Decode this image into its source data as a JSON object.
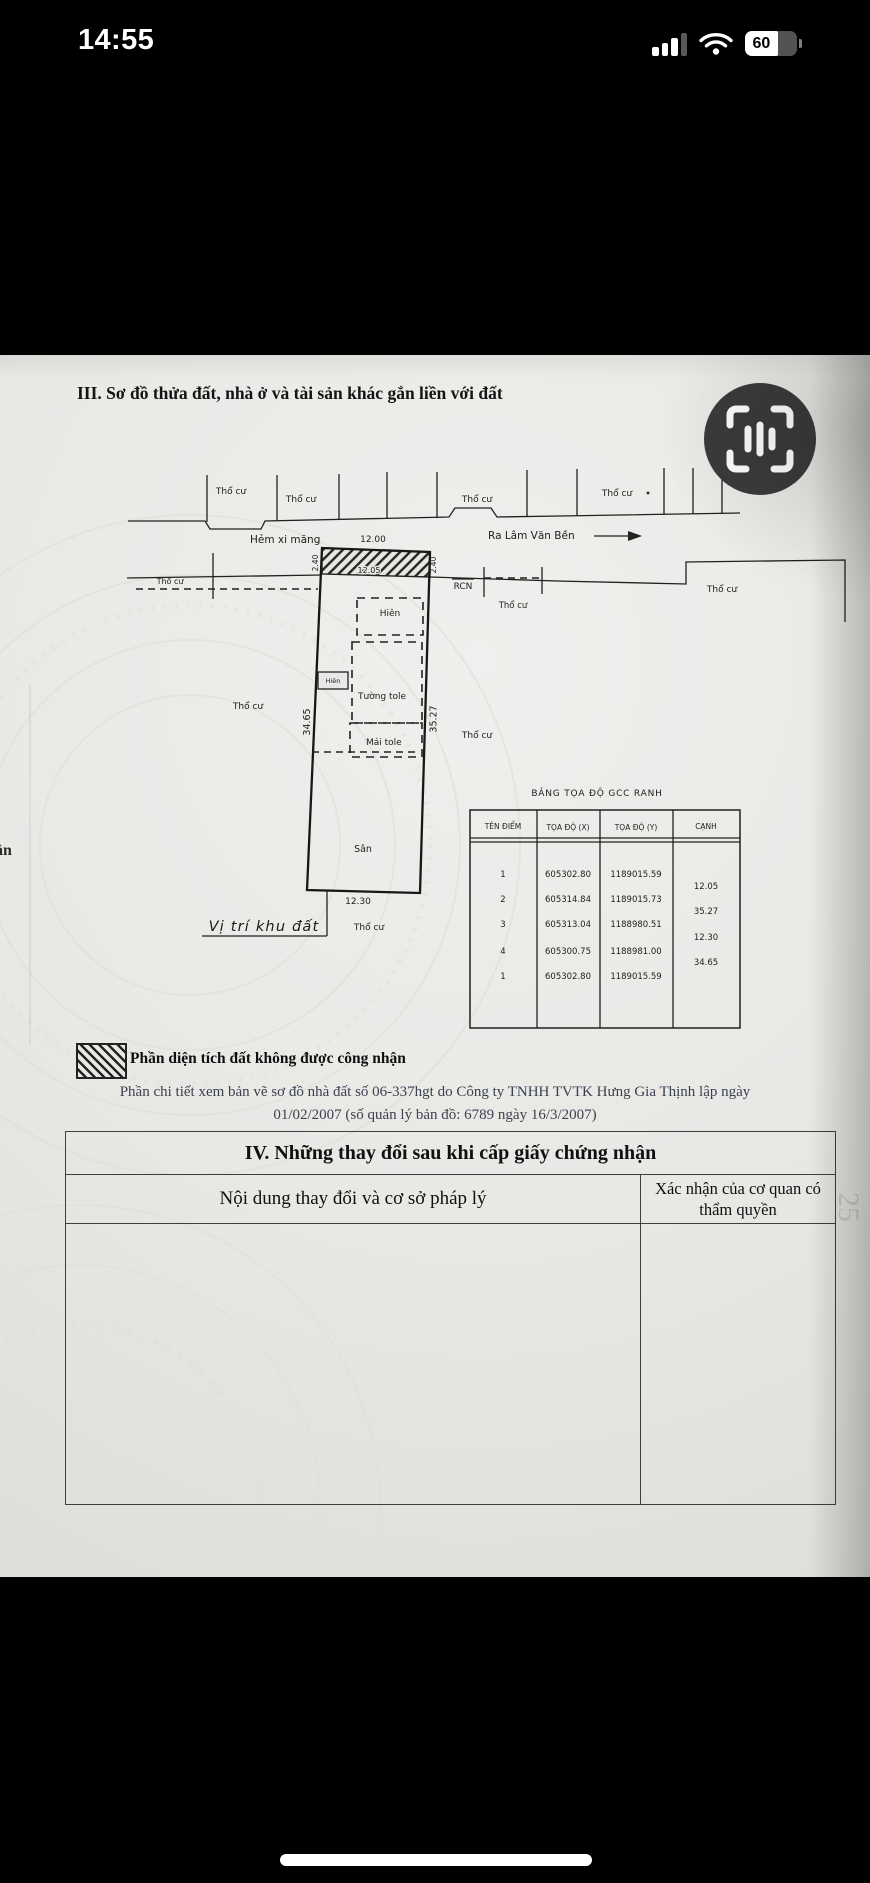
{
  "status_bar": {
    "time": "14:55",
    "battery": "60"
  },
  "doc": {
    "section3_title": "III. Sơ đồ thửa đất, nhà ở và tài sản khác gắn liền với đất",
    "edge_text": "ân",
    "page_number": "25",
    "map": {
      "tho_cu": "Thổ cư",
      "hem": "Hẻm xi măng",
      "ra": "Ra Lâm Văn Bền",
      "rcn": "RCN",
      "hien": "Hiên",
      "tuong_tole": "Tường tole",
      "mai_tole": "Mái tole",
      "san": "Sân",
      "vi_tri": "Vị trí khu đất",
      "dim_front": "12.00",
      "dim_front_inner": "12.05",
      "dim_setback": "2.40",
      "dim_left": "34.65",
      "dim_right": "35.27",
      "dim_back": "12.30"
    },
    "coord_table": {
      "title": "BẢNG TỌA ĐỘ GCC RANH",
      "headers": [
        "TÊN ĐIỂM",
        "TỌA ĐỘ (X)",
        "TỌA ĐỘ (Y)",
        "CẠNH"
      ],
      "rows": [
        [
          "1",
          "605302.80",
          "1189015.59"
        ],
        [
          "2",
          "605314.84",
          "1189015.73"
        ],
        [
          "3",
          "605313.04",
          "1188980.51"
        ],
        [
          "4",
          "605300.75",
          "1188981.00"
        ],
        [
          "1",
          "605302.80",
          "1189015.59"
        ]
      ],
      "edges": [
        "12.05",
        "35.27",
        "12.30",
        "34.65"
      ]
    },
    "legend": "Phần diện tích đất không được công nhận",
    "note1": "Phần chi tiết xem bản vẽ sơ đồ nhà đất số 06-337hgt do Công ty TNHH TVTK Hưng Gia Thịnh lập ngày",
    "note2": "01/02/2007 (số quản lý bản đồ: 6789 ngày 16/3/2007)",
    "section4": {
      "title": "IV. Những thay đổi sau khi cấp giấy chứng nhận",
      "left_header": "Nội dung thay đổi và cơ sở pháp lý",
      "right_header": "Xác nhận của cơ quan có thẩm quyền"
    }
  }
}
